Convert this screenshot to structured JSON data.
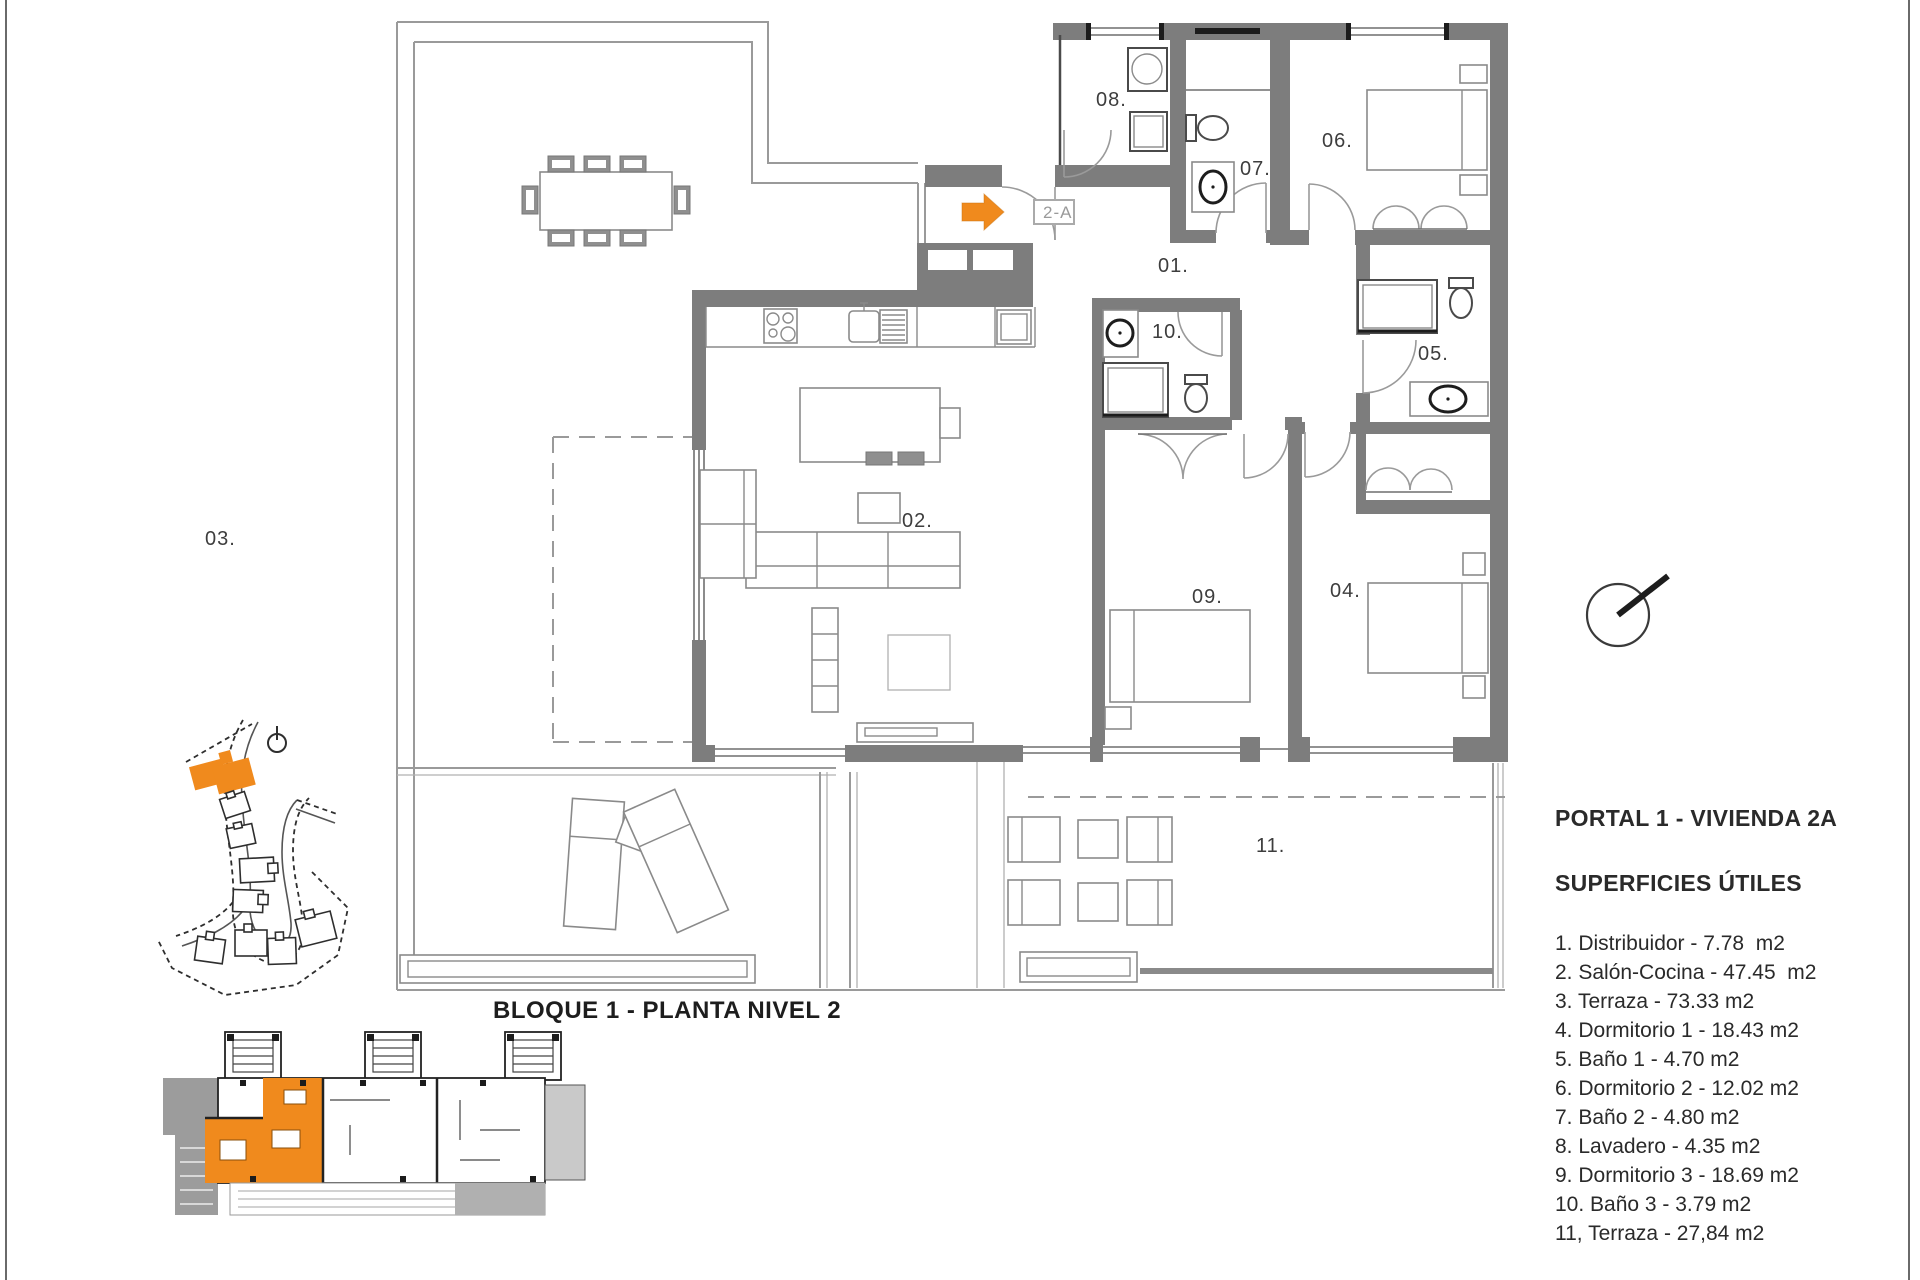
{
  "titles": {
    "plan": "BLOQUE 1 - PLANTA NIVEL 2",
    "unit": "PORTAL 1 - VIVIENDA 2A",
    "legend": "SUPERFICIES ÚTILES"
  },
  "entrance": {
    "tag": "2-A"
  },
  "rooms": {
    "r01": "01.",
    "r02": "02.",
    "r03": "03.",
    "r04": "04.",
    "r05": "05.",
    "r06": "06.",
    "r07": "07.",
    "r08": "08.",
    "r09": "09.",
    "r10": "10.",
    "r11": "11."
  },
  "legend": {
    "items": [
      "1. Distribuidor - 7.78  m2",
      "2. Salón-Cocina - 47.45  m2",
      "3. Terraza - 73.33 m2",
      "4. Dormitorio 1 - 18.43 m2",
      "5. Baño 1 - 4.70 m2",
      "6. Dormitorio 2 - 12.02 m2",
      "7. Baño 2 - 4.80 m2",
      "8. Lavadero - 4.35 m2",
      "9. Dormitorio 3 - 18.69 m2",
      "10. Baño 3 - 3.79 m2",
      "11, Terraza - 27,84 m2"
    ]
  },
  "colors": {
    "accent_orange": "#F08A1D",
    "wall_grey": "#7d7d7d",
    "line_grey": "#9a9a9a",
    "text_dark": "#1d1d1d"
  }
}
